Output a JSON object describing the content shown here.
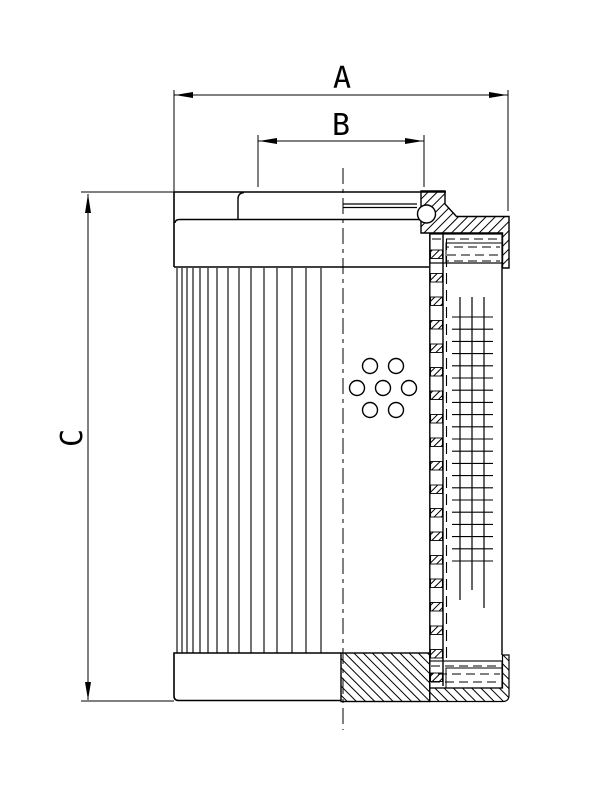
{
  "dimensions": {
    "a": "A",
    "b": "B",
    "c": "C"
  },
  "colors": {
    "line": "#000000",
    "background": "#ffffff"
  },
  "figure": {
    "pleat_xs": [
      177,
      182,
      187,
      193,
      200,
      208,
      217,
      228,
      239,
      251,
      264,
      277,
      292,
      306,
      321
    ],
    "pleat_top": 268,
    "pleat_bottom": 653,
    "holes": {
      "cx": 383,
      "cy": 388,
      "dx": 26,
      "dy": 22,
      "r": 7.5,
      "offsets": [
        [
          -0.5,
          -1
        ],
        [
          0.5,
          -1
        ],
        [
          -1,
          0
        ],
        [
          0,
          0
        ],
        [
          1,
          0
        ],
        [
          -0.5,
          1
        ],
        [
          0.5,
          1
        ]
      ]
    },
    "tube_squares": {
      "x": 430.6,
      "w": 11.8,
      "h": 8.5,
      "y_start": 250,
      "step": 23.5,
      "count": 19
    },
    "grid": {
      "h_x1": 452,
      "h_x2": 493,
      "h_y_start": 317,
      "h_step": 12.2,
      "h_count": 21,
      "v_lines": [
        [
          460,
          297,
          600
        ],
        [
          472,
          297,
          590
        ],
        [
          484,
          297,
          608
        ]
      ]
    },
    "seal_dash_rows_top": [
      [
        432,
        500,
        239
      ],
      [
        447,
        500,
        247
      ],
      [
        447,
        500,
        255
      ],
      [
        447,
        500,
        261
      ]
    ],
    "seal_dash_rows_bottom": [
      [
        431,
        500,
        666
      ],
      [
        431,
        500,
        674
      ],
      [
        431,
        500,
        682
      ]
    ]
  }
}
